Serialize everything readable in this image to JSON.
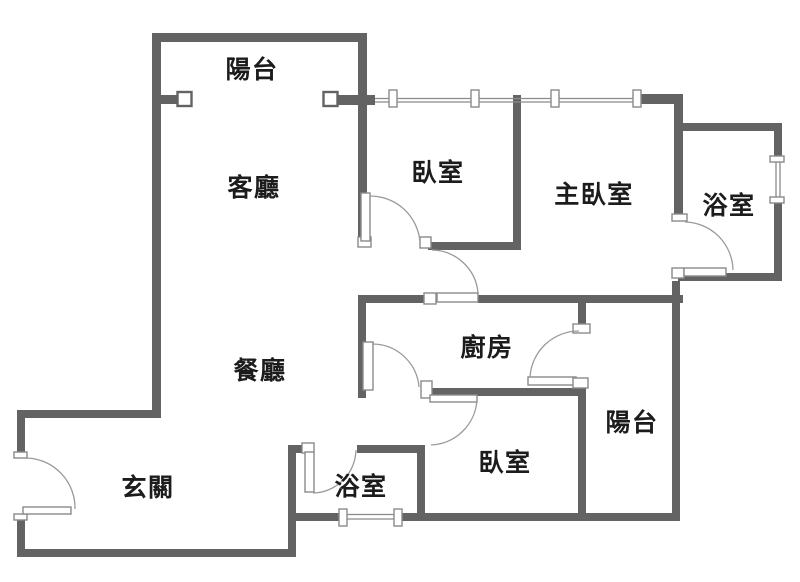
{
  "rooms": {
    "balcony_top": {
      "label": "陽台"
    },
    "living_room": {
      "label": "客廳"
    },
    "bedroom_top": {
      "label": "臥室"
    },
    "master_bedroom": {
      "label": "主臥室"
    },
    "bathroom_top": {
      "label": "浴室"
    },
    "dining_room": {
      "label": "餐廳"
    },
    "kitchen": {
      "label": "廚房"
    },
    "balcony_rear": {
      "label": "陽台"
    },
    "bedroom_bottom": {
      "label": "臥室"
    },
    "bathroom_bottom": {
      "label": "浴室"
    },
    "foyer": {
      "label": "玄關"
    }
  },
  "colors": {
    "wall": "#636363",
    "label_text": "#1c1c1c",
    "door_line": "#9a9a9a",
    "background": "#ffffff"
  }
}
